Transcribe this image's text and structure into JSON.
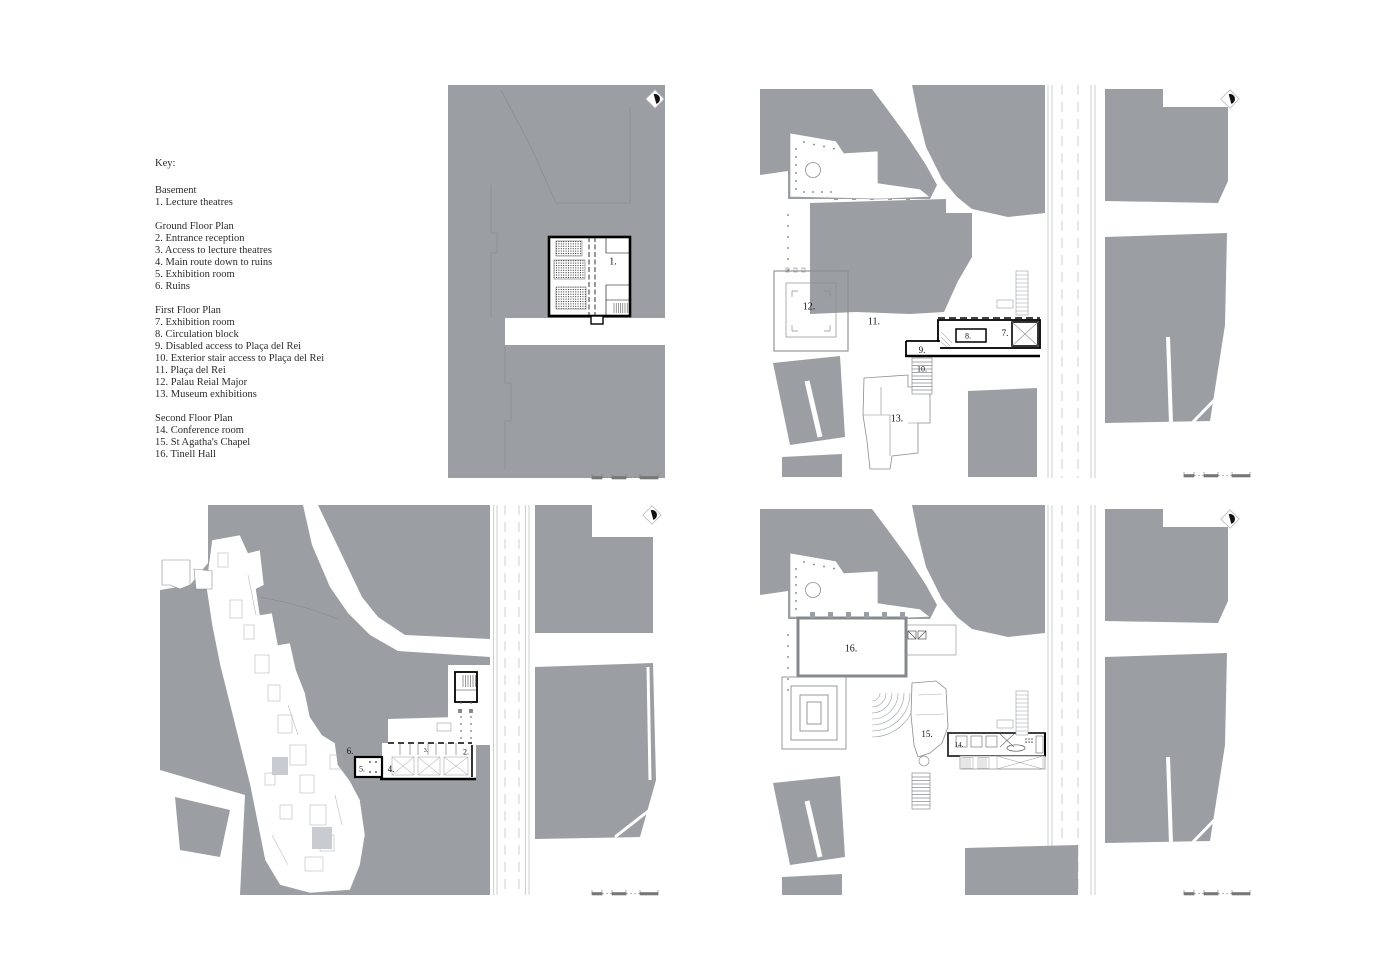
{
  "key": {
    "title": "Key:",
    "sections": [
      {
        "heading": "Basement",
        "items": [
          "1. Lecture theatres"
        ]
      },
      {
        "heading": "Ground Floor Plan",
        "items": [
          "2. Entrance reception",
          "3. Access to lecture theatres",
          "4. Main route down to ruins",
          "5. Exhibition room",
          "6. Ruins"
        ]
      },
      {
        "heading": "First Floor Plan",
        "items": [
          "7. Exhibition room",
          "8. Circulation block",
          "9. Disabled access to Plaça del Rei",
          "10. Exterior stair access to Plaça del Rei",
          "11. Plaça del Rei",
          "12. Palau Reial Major",
          "13. Museum exhibitions"
        ]
      },
      {
        "heading": "Second Floor Plan",
        "items": [
          "14. Conference room",
          "15. St Agatha's Chapel",
          "16. Tinell Hall"
        ]
      }
    ]
  },
  "plans": [
    {
      "id": "basement",
      "name": "Basement plan",
      "labels": [
        {
          "text": "1.",
          "x": 165,
          "y": 177,
          "size": 10
        }
      ]
    },
    {
      "id": "first-floor",
      "name": "First floor plan",
      "labels": [
        {
          "text": "12.",
          "x": 49,
          "y": 222,
          "size": 10
        },
        {
          "text": "11.",
          "x": 114,
          "y": 237,
          "size": 10
        },
        {
          "text": "7.",
          "x": 245,
          "y": 248,
          "size": 9
        },
        {
          "text": "8.",
          "x": 208,
          "y": 251,
          "size": 8
        },
        {
          "text": "9.",
          "x": 162,
          "y": 265,
          "size": 9
        },
        {
          "text": "10.",
          "x": 162,
          "y": 284,
          "size": 8
        },
        {
          "text": "13.",
          "x": 137,
          "y": 334,
          "size": 10
        }
      ]
    },
    {
      "id": "ground-floor",
      "name": "Ground floor plan",
      "labels": [
        {
          "text": "6.",
          "x": 190,
          "y": 246,
          "size": 9
        },
        {
          "text": "5.",
          "x": 202,
          "y": 264,
          "size": 8
        },
        {
          "text": "4.",
          "x": 231,
          "y": 264,
          "size": 9
        },
        {
          "text": "3.",
          "x": 266,
          "y": 246,
          "size": 6
        },
        {
          "text": "2.",
          "x": 306,
          "y": 247,
          "size": 8
        }
      ]
    },
    {
      "id": "second-floor",
      "name": "Second floor plan",
      "labels": [
        {
          "text": "16.",
          "x": 91,
          "y": 144,
          "size": 10
        },
        {
          "text": "15.",
          "x": 167,
          "y": 229,
          "size": 9
        },
        {
          "text": "14.",
          "x": 199,
          "y": 240,
          "size": 7
        }
      ]
    }
  ],
  "colors": {
    "block_gray": "#9b9ea3",
    "line_gray": "#8a8d91",
    "ink": "#111111"
  }
}
